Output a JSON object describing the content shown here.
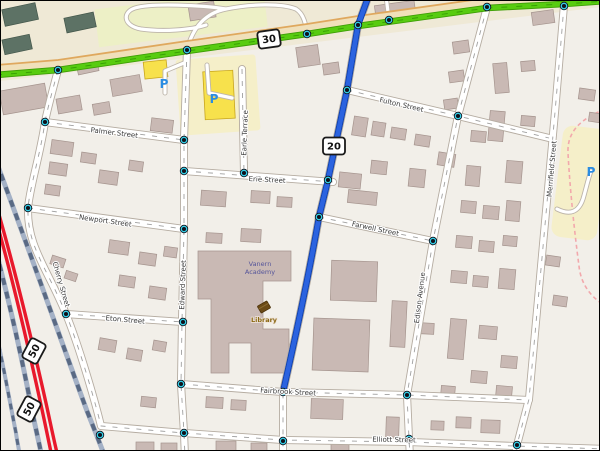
{
  "map": {
    "streets": {
      "palmer": "Palmer Street",
      "newport": "Newport Street",
      "eton": "Eton Street",
      "cherry": "Cherry Street",
      "edward": "Edward Street",
      "earle": "Earle Terrace",
      "erie": "Erie Street",
      "fulton": "Fulton Street",
      "farwell": "Farwell Street",
      "fairbrook": "Fairbrook Street",
      "elliott": "Elliott Street",
      "edison": "Edison Avenue",
      "merrifield": "Merrifield Street"
    },
    "shields": {
      "route30": "30",
      "route20": "20",
      "route50": "50"
    },
    "pois": {
      "library": "Library",
      "academy_line1": "Vanern",
      "academy_line2": "Academy",
      "parking_symbol": "P"
    },
    "colors": {
      "background": "#f2efe9",
      "land_north": "#efe9d6",
      "grass": "#edf0c6",
      "parking_lot": "#f5efc9",
      "building": "#c9b9b4",
      "building_dark": "#5d7265",
      "building_yellow": "#f7e14c",
      "road_green": "#58cc10",
      "route_highlight": "#2b63e0",
      "road_red": "#e8192c",
      "railway": "#a4b1c6",
      "parking_icon": "#2a8ce2",
      "library_label": "#8a6914",
      "academy_label": "#55559a"
    }
  }
}
